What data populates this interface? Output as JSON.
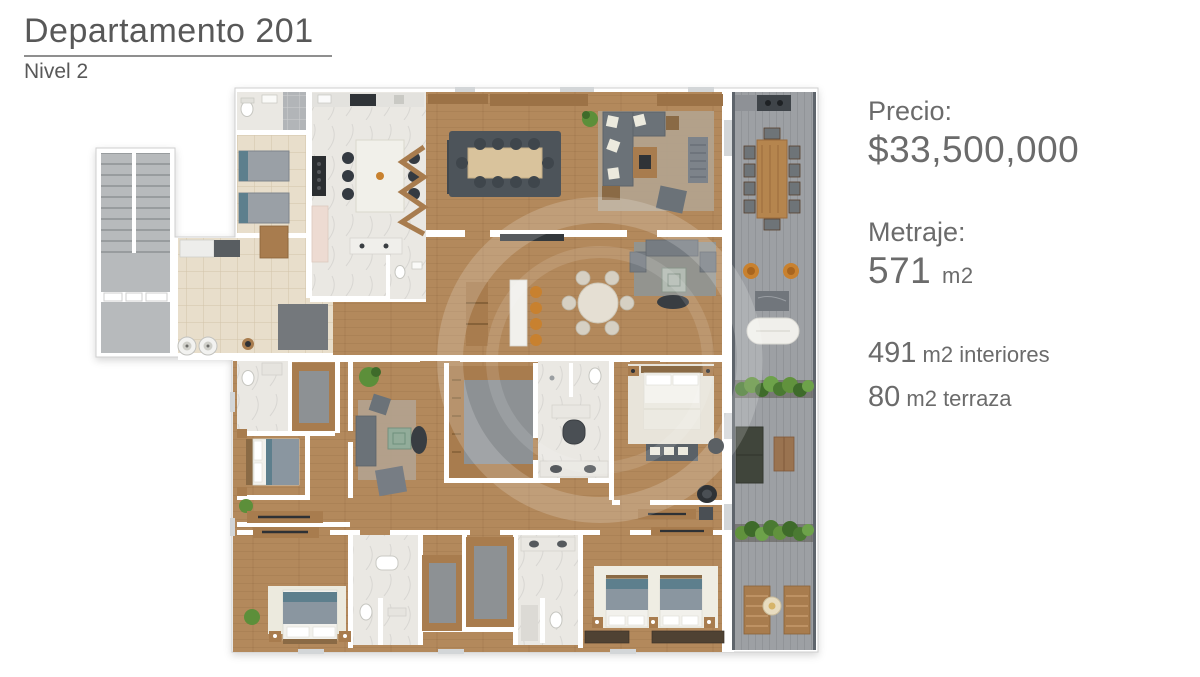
{
  "header": {
    "title": "Departamento 201",
    "subtitle": "Nivel 2"
  },
  "info": {
    "price_label": "Precio:",
    "price_value": "$33,500,000",
    "area_label": "Metraje:",
    "area_value": "571",
    "area_unit": "m2",
    "details": [
      {
        "value": "491",
        "unit": "m2 interiores"
      },
      {
        "value": "80",
        "unit": "m2 terraza"
      }
    ]
  },
  "colors": {
    "text": "#585858",
    "text2": "#6b6b6b",
    "wood": "#b3895c",
    "woodfurn": "#a87c4e",
    "marble": "#eae8e3",
    "tile": "#e8decb",
    "terrace": "#9da0a4",
    "concrete": "#b7babc",
    "sofa": "#6b7278",
    "dark": "#3c4146",
    "orange": "#c8812f",
    "green": "#5c8f3a",
    "bedblue": "#8a96a0",
    "teal": "#5d7f8d",
    "carpet": "#8d9194"
  }
}
